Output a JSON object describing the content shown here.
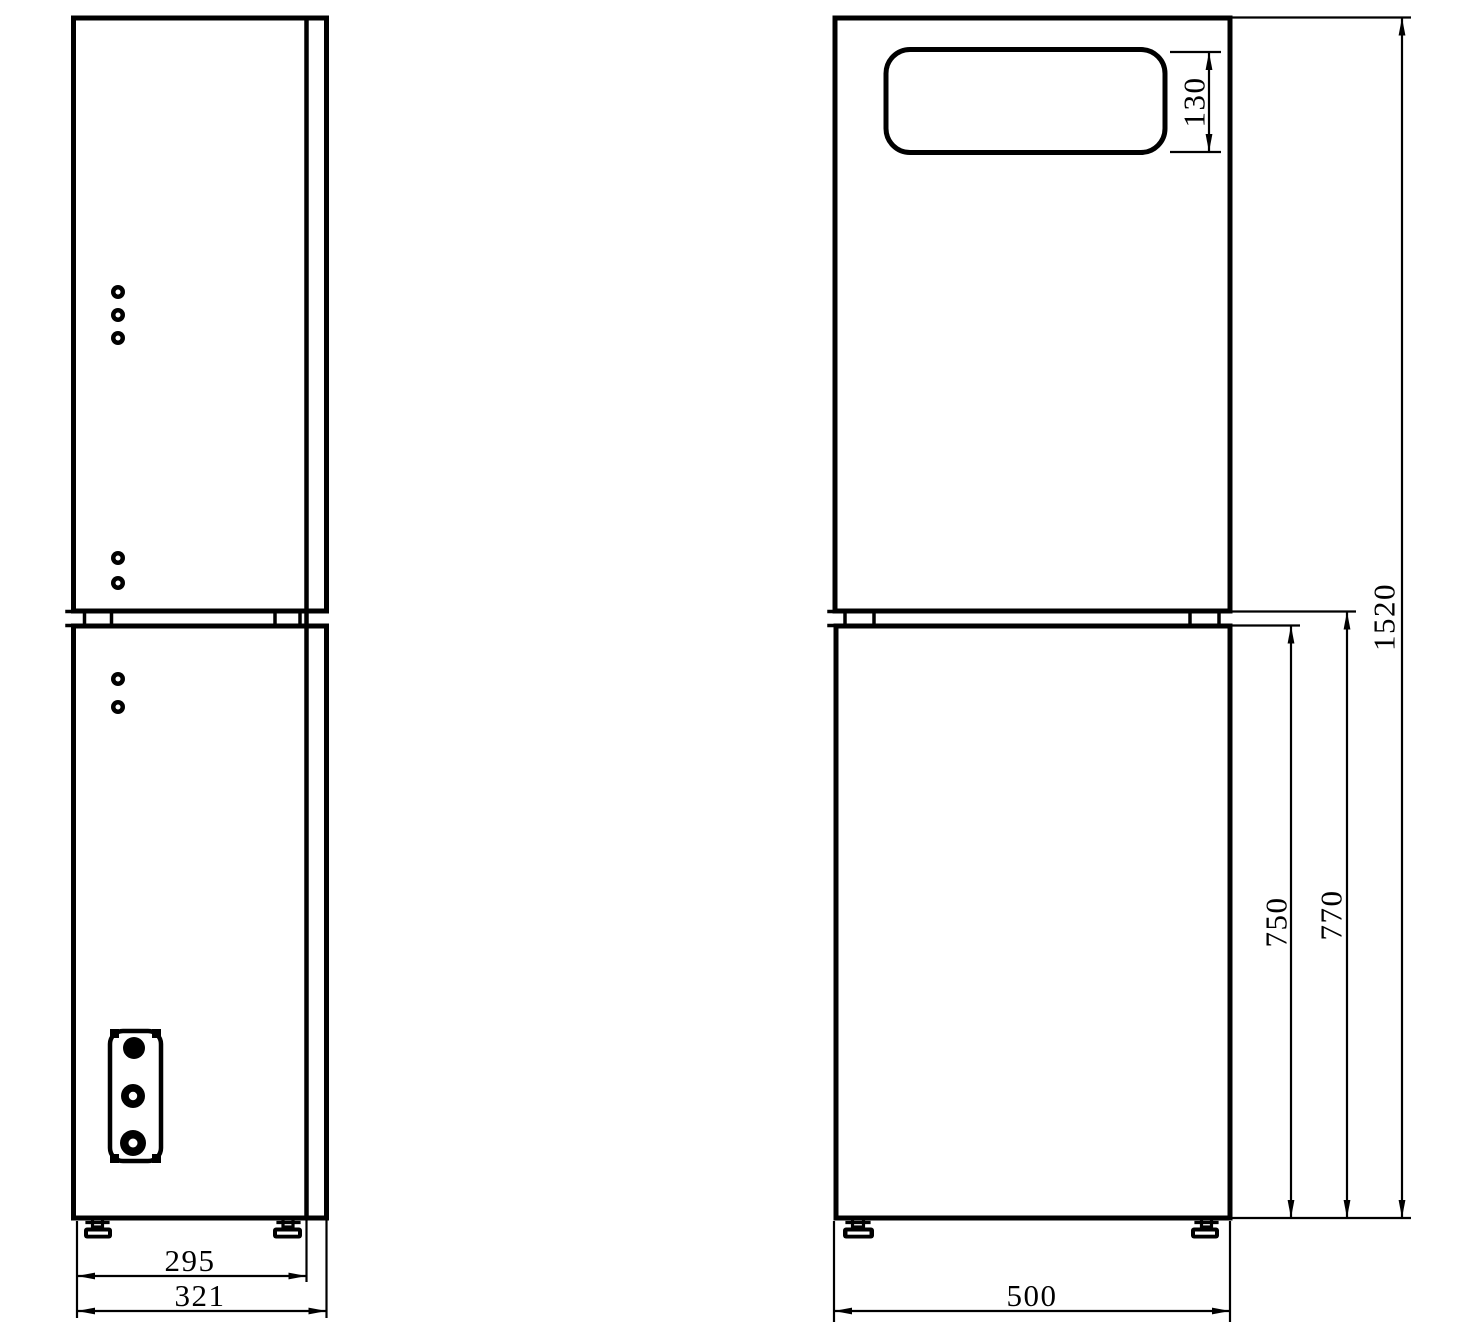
{
  "drawing": {
    "background_color": "#ffffff",
    "line_color": "#000000",
    "dimensions": {
      "slot_height": "130",
      "overall_height": "1520",
      "lower_section_height_overall": "770",
      "lower_section_height": "750",
      "front_width": "500",
      "side_depth": "295",
      "side_depth_overall": "321"
    }
  }
}
